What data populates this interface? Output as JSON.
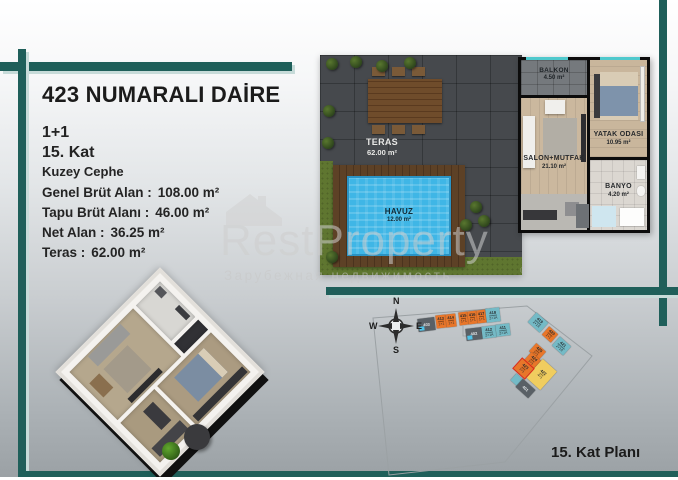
{
  "colors": {
    "accent": "#1f5f5a",
    "orange": "#e8762a",
    "blue": "#74bac6",
    "yellow": "#f0cd5f",
    "gray": "#596066",
    "highlight_red": "#e02818",
    "pool_blue": "#3fb6e6"
  },
  "header": {
    "title": "423 NUMARALI DAİRE"
  },
  "info": {
    "unit_type": "1+1",
    "floor": "15. Kat",
    "facade": "Kuzey Cephe",
    "details": [
      {
        "label": "Genel Brüt Alan :",
        "value": "108.00 m²"
      },
      {
        "label": "Tapu Brüt Alanı :",
        "value": "46.00 m²"
      },
      {
        "label": "Net Alan :",
        "value": "36.25 m²"
      },
      {
        "label": "Teras :",
        "value": "62.00 m²"
      }
    ]
  },
  "floor_plan": {
    "teras": {
      "name": "TERAS",
      "area": "62.00 m²"
    },
    "havuz": {
      "name": "HAVUZ",
      "area": "12.00 m²"
    },
    "balkon": {
      "name": "BALKON",
      "area": "4.50 m²"
    },
    "salon": {
      "name": "SALON+MUTFAK",
      "area": "21.10 m²"
    },
    "yatak": {
      "name": "YATAK ODASI",
      "area": "10.95 m²"
    },
    "banyo": {
      "name": "BANYO",
      "area": "4.20 m²"
    }
  },
  "watermark": {
    "brand": "RestProperty",
    "subtitle": "Зарубежная недвижимость",
    "reg": "®"
  },
  "site_plan": {
    "caption": "15. Kat Planı",
    "compass": {
      "n": "N",
      "e": "E",
      "s": "S",
      "w": "W"
    },
    "units": [
      {
        "label": "403",
        "type": "",
        "x": 50,
        "y": 22,
        "w": 17,
        "h": 13,
        "color": "gray",
        "rot": -7,
        "pool": true
      },
      {
        "label": "413",
        "type": "1+1",
        "x": 68,
        "y": 19,
        "w": 10,
        "h": 13,
        "color": "orange",
        "rot": -7
      },
      {
        "label": "414",
        "type": "1+1",
        "x": 78,
        "y": 18,
        "w": 10,
        "h": 13,
        "color": "orange",
        "rot": -7
      },
      {
        "label": "415",
        "type": "1+1",
        "x": 91,
        "y": 16,
        "w": 9,
        "h": 13,
        "color": "orange",
        "rot": -7
      },
      {
        "label": "416",
        "type": "1+1",
        "x": 100,
        "y": 15,
        "w": 9,
        "h": 13,
        "color": "orange",
        "rot": -7
      },
      {
        "label": "417",
        "type": "1+1",
        "x": 109,
        "y": 14,
        "w": 9,
        "h": 13,
        "color": "orange",
        "rot": -7
      },
      {
        "label": "418",
        "type": "2+1A",
        "x": 118,
        "y": 12,
        "w": 14,
        "h": 14,
        "color": "blue",
        "rot": -7
      },
      {
        "label": "402",
        "type": "",
        "x": 98,
        "y": 32,
        "w": 16,
        "h": 12,
        "color": "gray",
        "rot": -7,
        "pool": true
      },
      {
        "label": "412",
        "type": "2+1A",
        "x": 114,
        "y": 30,
        "w": 14,
        "h": 12,
        "color": "blue",
        "rot": -7
      },
      {
        "label": "411",
        "type": "2+1A",
        "x": 128,
        "y": 28,
        "w": 14,
        "h": 12,
        "color": "blue",
        "rot": -7
      },
      {
        "label": "419",
        "type": "2+1A",
        "x": 162,
        "y": 20,
        "w": 16,
        "h": 13,
        "color": "blue",
        "rot": 42
      },
      {
        "label": "420",
        "type": "1+1",
        "x": 176,
        "y": 33,
        "w": 12,
        "h": 11,
        "color": "orange",
        "rot": 42
      },
      {
        "label": "421",
        "type": "2+1A",
        "x": 186,
        "y": 44,
        "w": 15,
        "h": 12,
        "color": "blue",
        "rot": 42
      },
      {
        "label": "425",
        "type": "1+1",
        "x": 163,
        "y": 50,
        "w": 13,
        "h": 11,
        "color": "orange",
        "rot": 42
      },
      {
        "label": "424",
        "type": "1+1",
        "x": 158,
        "y": 59,
        "w": 13,
        "h": 11,
        "color": "orange",
        "rot": 42
      },
      {
        "label": "423",
        "type": "1+1",
        "x": 148,
        "y": 66,
        "w": 15,
        "h": 13,
        "color": "orange",
        "rot": 42,
        "highlight": true
      },
      {
        "label": "422",
        "type": "4+1",
        "x": 164,
        "y": 66,
        "w": 19,
        "h": 25,
        "color": "yellow",
        "rot": 42
      },
      {
        "label": "",
        "type": "",
        "x": 144,
        "y": 80,
        "w": 11,
        "h": 9,
        "color": "blue",
        "rot": 42,
        "pool": true
      },
      {
        "label": "401",
        "type": "",
        "x": 149,
        "y": 87,
        "w": 17,
        "h": 11,
        "color": "gray",
        "rot": 42
      }
    ]
  }
}
